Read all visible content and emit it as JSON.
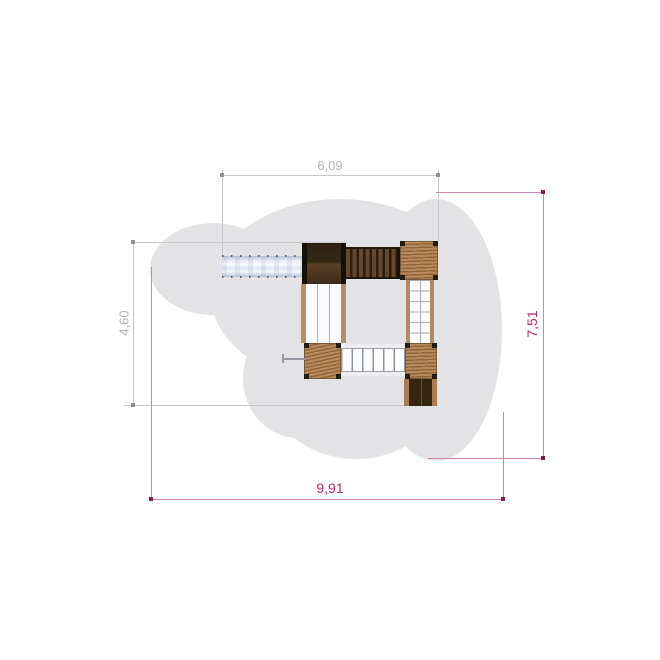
{
  "drawing": {
    "type": "playground-equipment-plan-view",
    "dimensions": {
      "top_width": "6,09",
      "left_height": "4,60",
      "bottom_width": "9,91",
      "right_height": "7,51"
    },
    "colors": {
      "safety_zone_gray": "#e3e3e5",
      "dimension_gray_line": "#c8c8c8",
      "dimension_gray_text": "#b2b2b2",
      "dimension_pink_line": "#d183ae",
      "dimension_pink_text": "#b42c74",
      "wood_light": "#b68b5d",
      "rope_platform": "#ac7e4f",
      "wood_dark": "#372a18",
      "slide_metal": "#dde5f0"
    }
  }
}
